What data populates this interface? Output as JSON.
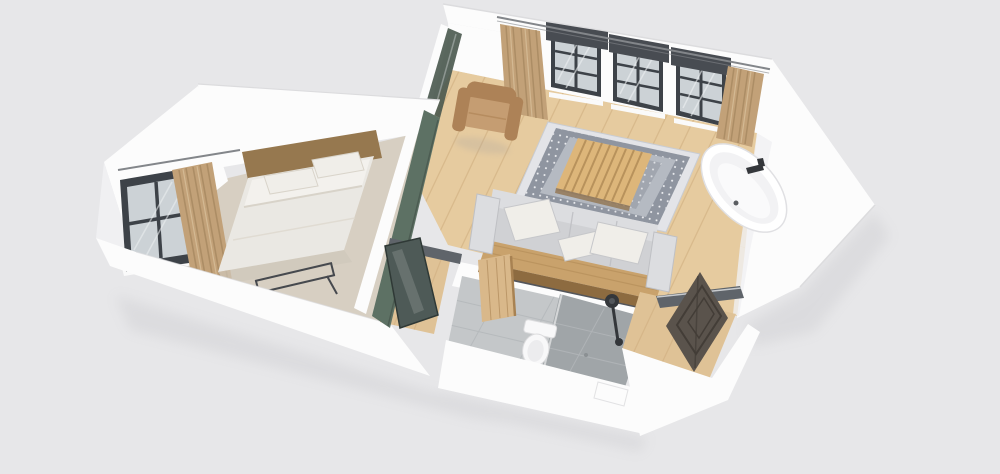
{
  "scene": {
    "description": "3D isometric cutaway render of a one-bedroom apartment floor plan on a light gray background",
    "view": "perspective from above",
    "accent_wall": "sage green",
    "rooms": [
      {
        "name": "bedroom",
        "floor": "beige carpet",
        "objects": [
          "double bed with white duvet and two pillows",
          "wooden headboard",
          "black metal luggage rack at foot of bed",
          "dark-framed window",
          "beige curtains"
        ]
      },
      {
        "name": "living-room",
        "floor": "light oak plank flooring",
        "objects": [
          "gray fabric sofa with three cushions on wooden platform",
          "ornate gray and white area rug",
          "slatted wooden coffee table",
          "tan armchair",
          "three black-framed windows with dark pelmets",
          "beige curtains",
          "curtain rod",
          "freestanding white oval bathtub with black faucet",
          "sage green accent wall",
          "dark glass interior door"
        ]
      },
      {
        "name": "bathroom",
        "floor": "gray tile",
        "objects": [
          "white toilet",
          "walk-in shower with black overhead fixture",
          "darker tiled shower zone",
          "light wooden door standing open"
        ]
      },
      {
        "name": "entry",
        "floor": "light oak plank flooring",
        "objects": [
          "dark paneled front door standing open",
          "gray door header beam"
        ]
      }
    ]
  },
  "colors": {
    "bg": "#e7e7e9",
    "wallWhite": "#fcfcfc",
    "wallShade": "#f0f0f2",
    "wallEdge": "#dcdcde",
    "woodFloor": "#e6cb9f",
    "woodLine": "#d2b183",
    "carpet": "#d7cfc2",
    "hallWood": "#dfc296",
    "greenWall": "#5d7164",
    "greenDark": "#49584e",
    "windowFrame": "#3d4248",
    "windowGlass": "#ccd2d6",
    "glassStreak": "#eef1f3",
    "pelmet": "#484c52",
    "rodMetal": "#83868a",
    "curtain": "#c2a178",
    "curtainDark": "#a5875f",
    "curtainLight": "#d8bf9a",
    "rugBorder": "#e3e4e8",
    "rugBand": "#8f95a0",
    "rugField": "#b5bac2",
    "rugDot": "#f0f1f4",
    "sofa": "#d0d1d4",
    "sofaLight": "#dcdde0",
    "sofaEdge": "#bfc0c4",
    "sofaShadow": "#3c3f44",
    "platformWood": "#c9a26c",
    "platformFace": "#8d6b40",
    "tableWood": "#ddb67a",
    "tableLine": "#b28c57",
    "armchair": "#c59d72",
    "armchairDark": "#ad8257",
    "bedDuvet": "#eae8e3",
    "bedSheet": "#f3f1ed",
    "bedPillow": "#f0eee9",
    "bedShadow": "#cfc8bb",
    "headboard": "#96784f",
    "rackMetal": "#46494e",
    "tub": "#ffffff",
    "tubInner": "#f2f2f4",
    "fixture": "#34373b",
    "tile": "#c4c7c9",
    "tileDark": "#a0a5a8",
    "tileLine": "#b3b7ba",
    "toilet": "#f8f8f9",
    "doorWood": "#d9b88a",
    "doorWoodEdge": "#a88252",
    "frontDoor": "#5a534c",
    "frontDoorPanel": "#433d37",
    "glassDoor": "#4e5a57",
    "beamMetal": "#5f646a",
    "shadow": "#9a9aa0"
  }
}
